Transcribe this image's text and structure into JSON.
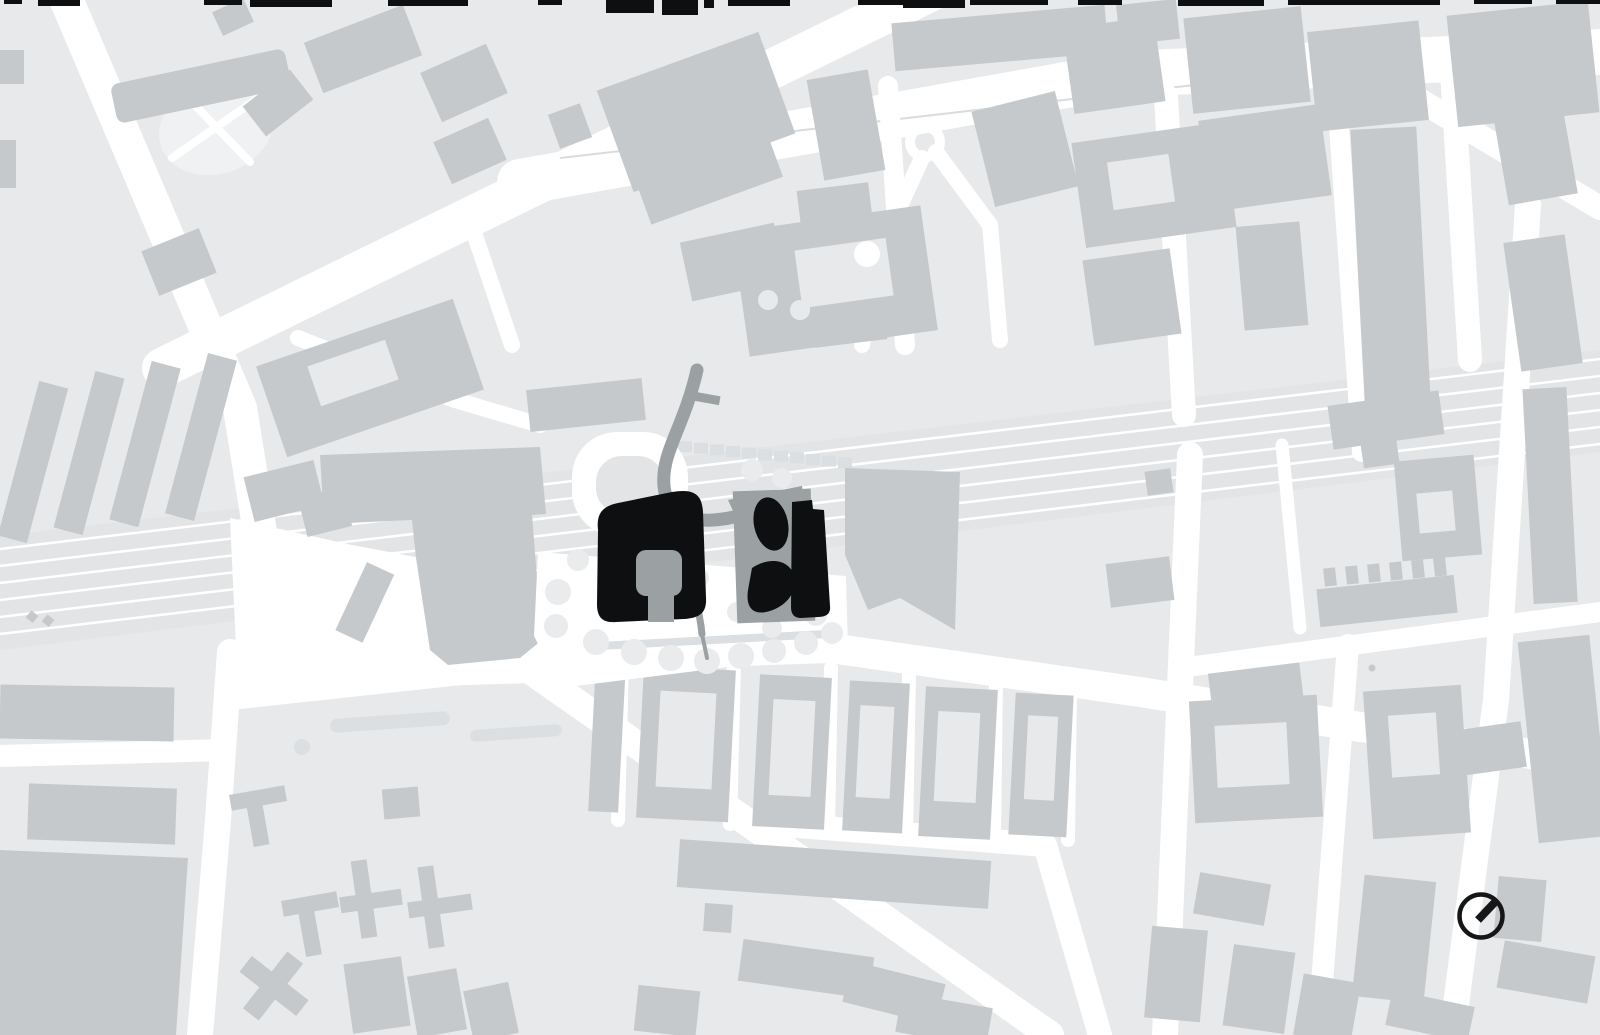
{
  "colors": {
    "road": "#ffffff",
    "block": "#e8e9ea",
    "building": "#c6c9cb",
    "corridor": "#e2e4e6",
    "tooth": "#dcdfe1",
    "dark": "#9ba0a3",
    "black": "#0d0f10",
    "tree": "#eaebec",
    "park": "#f0f1f2",
    "median": "#d9dbdc",
    "compass": "#141617"
  },
  "railway": {
    "track_count": 6,
    "left_y": 549,
    "right_y": 359,
    "spacing": 17,
    "track_width": 2.5
  },
  "sawtooth": {
    "x0": 646,
    "y0": 438,
    "step": 16,
    "drop": 1.6,
    "count": 13,
    "w": 14,
    "h": 11
  },
  "trees": [
    [
      558,
      592,
      13
    ],
    [
      556,
      626,
      12
    ],
    [
      578,
      560,
      11
    ],
    [
      596,
      642,
      13
    ],
    [
      634,
      652,
      13
    ],
    [
      671,
      658,
      13
    ],
    [
      707,
      661,
      13
    ],
    [
      741,
      656,
      13
    ],
    [
      774,
      651,
      12
    ],
    [
      806,
      643,
      12
    ],
    [
      832,
      633,
      11
    ],
    [
      816,
      615,
      11
    ],
    [
      772,
      628,
      10
    ],
    [
      737,
      612,
      10
    ],
    [
      700,
      578,
      9
    ],
    [
      752,
      470,
      11
    ],
    [
      782,
      478,
      10
    ]
  ],
  "top_fringe": [
    [
      4,
      18,
      4
    ],
    [
      38,
      42,
      6
    ],
    [
      204,
      38,
      5
    ],
    [
      250,
      82,
      7
    ],
    [
      388,
      80,
      6
    ],
    [
      538,
      24,
      5
    ],
    [
      606,
      48,
      13
    ],
    [
      662,
      36,
      15
    ],
    [
      704,
      10,
      8
    ],
    [
      728,
      62,
      6
    ],
    [
      858,
      46,
      5
    ],
    [
      903,
      62,
      8
    ],
    [
      970,
      78,
      5
    ],
    [
      1078,
      44,
      5
    ],
    [
      1178,
      86,
      6
    ],
    [
      1288,
      152,
      5
    ],
    [
      1474,
      58,
      4
    ],
    [
      1556,
      44,
      4
    ]
  ],
  "compass": {
    "cx": 1481,
    "cy": 916,
    "radius": 21.5,
    "ring_width": 4.5,
    "needle": {
      "x1": 1478,
      "y1": 920,
      "x2": 1497,
      "y2": 900,
      "width": 8
    }
  }
}
